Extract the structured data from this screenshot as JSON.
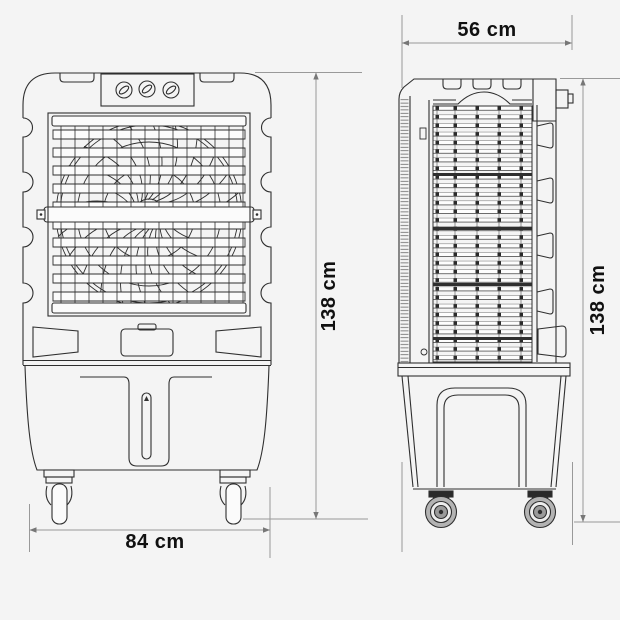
{
  "diagram": {
    "type": "technical-dimension-drawing",
    "subject": "evaporative air cooler, front and side orthographic views"
  },
  "dimensions": {
    "side_width": {
      "label": "56 cm",
      "value_cm": 56
    },
    "front_height": {
      "label": "138 cm",
      "value_cm": 138
    },
    "side_height": {
      "label": "138 cm",
      "value_cm": 138
    },
    "front_width": {
      "label": "84 cm",
      "value_cm": 84
    }
  },
  "colors": {
    "background": "#f4f4f4",
    "drawing_line": "#2f2f2f",
    "dimension_line": "#999999",
    "text": "#111111"
  }
}
